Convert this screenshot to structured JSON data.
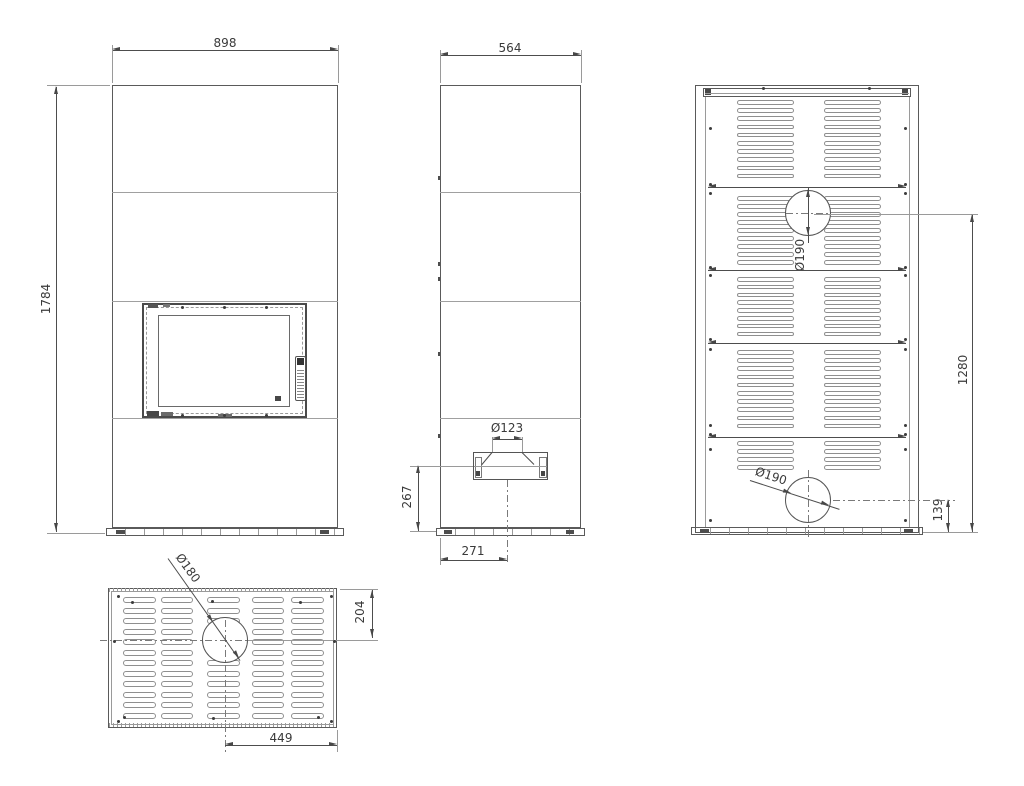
{
  "drawing": {
    "front_view": {
      "dim_width": "898",
      "dim_height": "1784"
    },
    "side_view": {
      "dim_depth": "564",
      "dim_intake_diameter": "Ø123",
      "dim_intake_center_height": "267",
      "dim_intake_center_offset": "271"
    },
    "back_view": {
      "dim_flue_diameter": "Ø190",
      "dim_flue_center_height": "1280",
      "dim_outlet_diameter": "Ø190",
      "dim_outlet_center_height": "139"
    },
    "top_view": {
      "dim_flue_diameter": "Ø180",
      "dim_flue_center_from_edge": "204",
      "dim_flue_center_to_side": "449"
    }
  }
}
